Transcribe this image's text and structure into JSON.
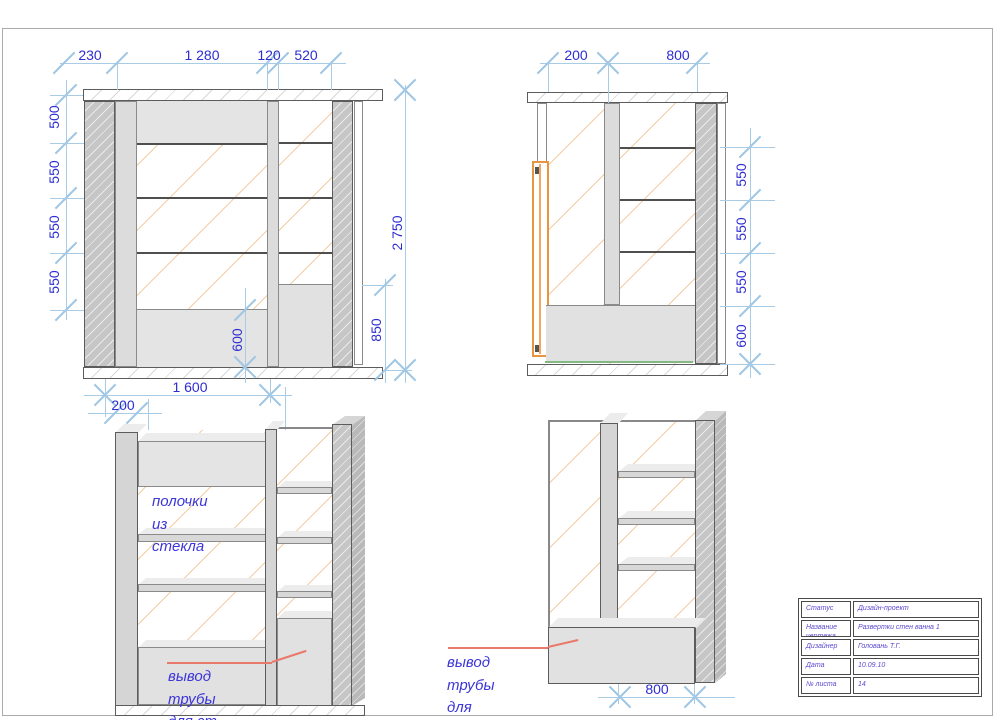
{
  "sheet": {
    "kind": "interior design drawing, bathroom wall elevations"
  },
  "colors": {
    "dim_text": "#2d2dd2",
    "dim_line": "#a8cbe6",
    "note_text": "#3c35d8",
    "leader_red": "#e8796b",
    "door_orange": "#e8953f",
    "floor_green": "#83b983"
  },
  "front_view": {
    "dim_230": "230",
    "dim_1280": "1 280",
    "dim_120": "120",
    "dim_520": "520",
    "dim_500": "500",
    "dim_550a": "550",
    "dim_550b": "550",
    "dim_550c": "550",
    "dim_2750": "2 750",
    "dim_850": "850",
    "dim_600": "600",
    "dim_1600": "1 600",
    "dim_200": "200"
  },
  "side_view": {
    "dim_200": "200",
    "dim_800": "800",
    "dim_550a": "550",
    "dim_550b": "550",
    "dim_550c": "550",
    "dim_600": "600"
  },
  "persp_left": {
    "note_glass": "полочки из\nстекла",
    "note_pipe": "вывод трубы для ст.\nмашины"
  },
  "persp_right": {
    "note_pipe": "вывод трубы для\nмойки",
    "dim_800": "800"
  },
  "title_block": {
    "rows": [
      {
        "label": "Статус",
        "value": "Дизайн-проект"
      },
      {
        "label": "Название\nчертежа",
        "value": "Развертки стен ванна 1"
      },
      {
        "label": "Дизайнер",
        "value": "Головань Т.Г."
      },
      {
        "label": "Дата",
        "value": "10.09.10"
      },
      {
        "label": "№ листа",
        "value": "14"
      }
    ]
  }
}
